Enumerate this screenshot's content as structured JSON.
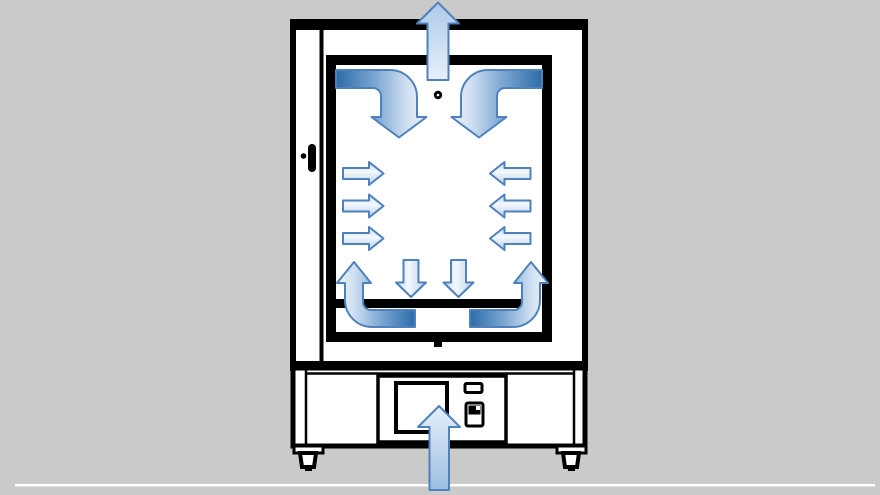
{
  "diagram": {
    "title": "Laboratory oven airflow schematic, front view",
    "type": "airflow-schematic",
    "colors": {
      "bg": "#cacaca",
      "floor_line": "#ffffff",
      "outline": "#000000",
      "panel": "#ffffff",
      "arrow_stroke": "#4f81bd",
      "side_edge": "#c5d8ee",
      "side_bright": "#f3f8fd",
      "side_deep": "#b9d0ea",
      "big_head": "#adcae8",
      "big_light": "#e6effa",
      "intake_deep": "#9cbfe2",
      "bent_dark": "#2d6ba8",
      "bent_mid": "#7ea9d4",
      "bent_soft": "#cfdff1",
      "bent_light": "#edf4fb"
    },
    "components": [
      "outer-cabinet",
      "door-hinge-line",
      "door-handle",
      "inner-chamber",
      "vent-hole",
      "bottom-plate",
      "base-unit",
      "control-panel",
      "display-window",
      "indicator-slot",
      "power-switch",
      "leveling-foot-left",
      "leveling-foot-right",
      "floor-line"
    ],
    "airflow_arrows": [
      {
        "name": "exhaust-arrow",
        "direction": "up",
        "count": 1,
        "location": "top center, exiting through cabinet top"
      },
      {
        "name": "top-left-curve-arrow",
        "direction": "down",
        "count": 1,
        "location": "upper left of chamber, bending from ceiling downward"
      },
      {
        "name": "top-right-curve-arrow",
        "direction": "down",
        "count": 1,
        "location": "upper right of chamber, bending from ceiling downward"
      },
      {
        "name": "left-wall-arrows",
        "direction": "right",
        "count": 3,
        "location": "left chamber wall pointing inward"
      },
      {
        "name": "right-wall-arrows",
        "direction": "left",
        "count": 3,
        "location": "right chamber wall pointing inward"
      },
      {
        "name": "center-down-arrows",
        "direction": "down",
        "count": 2,
        "location": "center of chamber above bottom plate"
      },
      {
        "name": "bottom-left-curve-arrow",
        "direction": "up",
        "count": 1,
        "location": "lower left, bending from under plate up the wall"
      },
      {
        "name": "bottom-right-curve-arrow",
        "direction": "up",
        "count": 1,
        "location": "lower right, bending from under plate up the wall"
      },
      {
        "name": "intake-arrow",
        "direction": "up",
        "count": 1,
        "location": "bottom center, entering base through control panel"
      }
    ]
  }
}
